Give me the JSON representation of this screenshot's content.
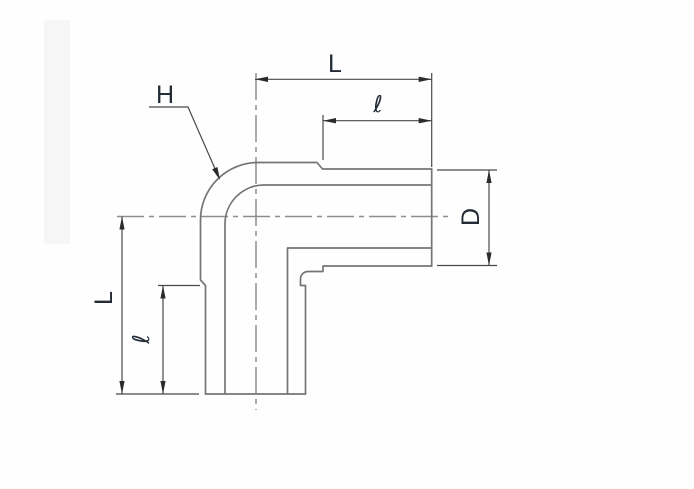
{
  "drawing": {
    "title": "90-degree elbow tube fitting dimensional drawing",
    "labels": {
      "length_top": "L",
      "tube_insertion_top": "ℓ",
      "bend_height": "H",
      "diameter_right": "D",
      "length_left": "L",
      "tube_insertion_left": "ℓ"
    },
    "colors": {
      "outline": "#757575",
      "centerline": "#8d8d8d",
      "dimension": "#494949",
      "arrow": "#2b2b2b",
      "text": "#222b36",
      "background": "#fefefe",
      "scan_band": "#f6f6f6"
    }
  }
}
